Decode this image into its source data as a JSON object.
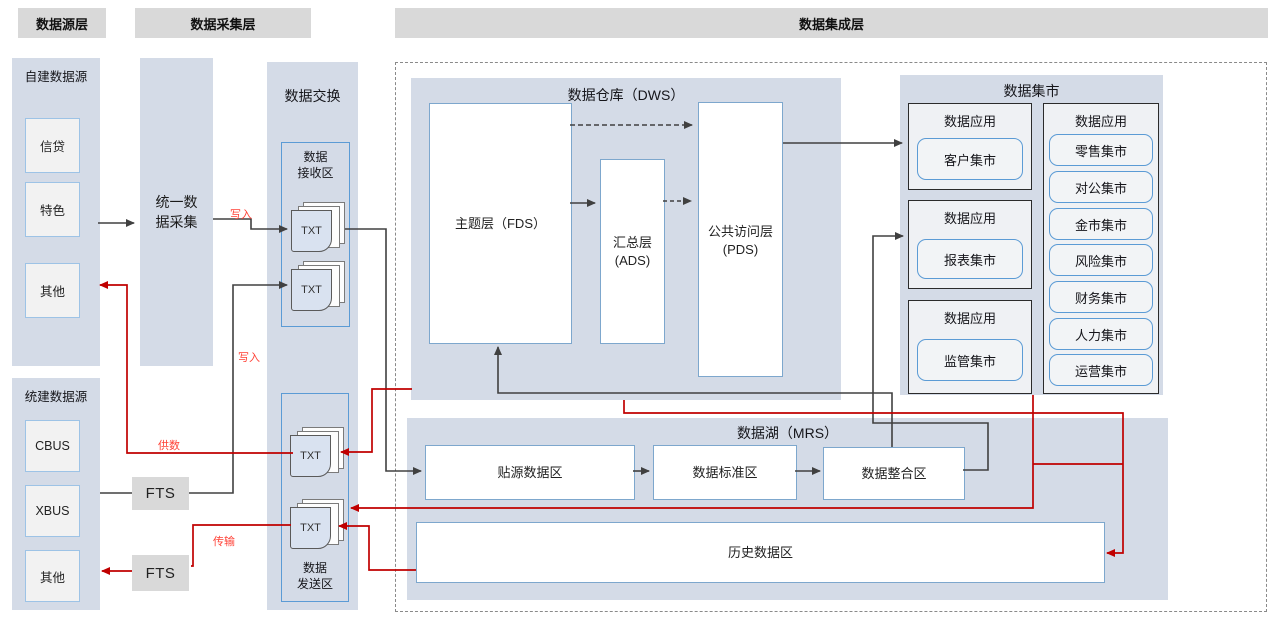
{
  "title_headers": {
    "source": "数据源层",
    "collection": "数据采集层",
    "integration": "数据集成层"
  },
  "source_layer": {
    "self_built": {
      "title": "自建数据源",
      "items": [
        "信贷",
        "特色",
        "其他"
      ]
    },
    "unified": {
      "title": "统建数据源",
      "items": [
        "CBUS",
        "XBUS",
        "其他"
      ]
    }
  },
  "collection_layer": {
    "unified_collection_lines": [
      "统一数",
      "据采集"
    ],
    "fts_top": "FTS",
    "fts_bottom": "FTS"
  },
  "exchange": {
    "title": "数据交换",
    "receive_area": {
      "label_lines": [
        "数据",
        "接收区"
      ],
      "files": [
        "TXT",
        "TXT"
      ]
    },
    "send_area": {
      "label_lines": [
        "数据",
        "发送区"
      ],
      "files": [
        "TXT",
        "TXT"
      ]
    }
  },
  "integration": {
    "dws": {
      "title": "数据仓库（DWS）",
      "fds": "主题层（FDS）",
      "ads_lines": [
        "汇总层",
        "(ADS)"
      ],
      "pds_lines": [
        "公共访问层",
        "(PDS)"
      ]
    },
    "mart": {
      "title": "数据集市",
      "groups": [
        {
          "label": "数据应用",
          "item": "客户集市"
        },
        {
          "label": "数据应用",
          "item": "报表集市"
        },
        {
          "label": "数据应用",
          "item": "监管集市"
        }
      ],
      "right_group": {
        "label": "数据应用",
        "items": [
          "零售集市",
          "对公集市",
          "金市集市",
          "风险集市",
          "财务集市",
          "人力集市",
          "运营集市"
        ]
      }
    },
    "mrs": {
      "title": "数据湖（MRS）",
      "zones": [
        "贴源数据区",
        "数据标准区",
        "数据整合区"
      ],
      "history": "历史数据区"
    }
  },
  "flow_labels": {
    "write_top": "写入",
    "write_bottom": "写入",
    "supply": "供数",
    "transfer": "传输"
  },
  "colors": {
    "panel": "#d4dbe7",
    "header": "#d9d9d9",
    "blue_border": "#5b9bd5",
    "light_blue_border": "#9dc3e6",
    "black_line": "#404040",
    "red_line": "#c00000",
    "red_label": "#ff4136",
    "box_fill": "#f2f2f2",
    "app_fill": "#eff1f4"
  }
}
